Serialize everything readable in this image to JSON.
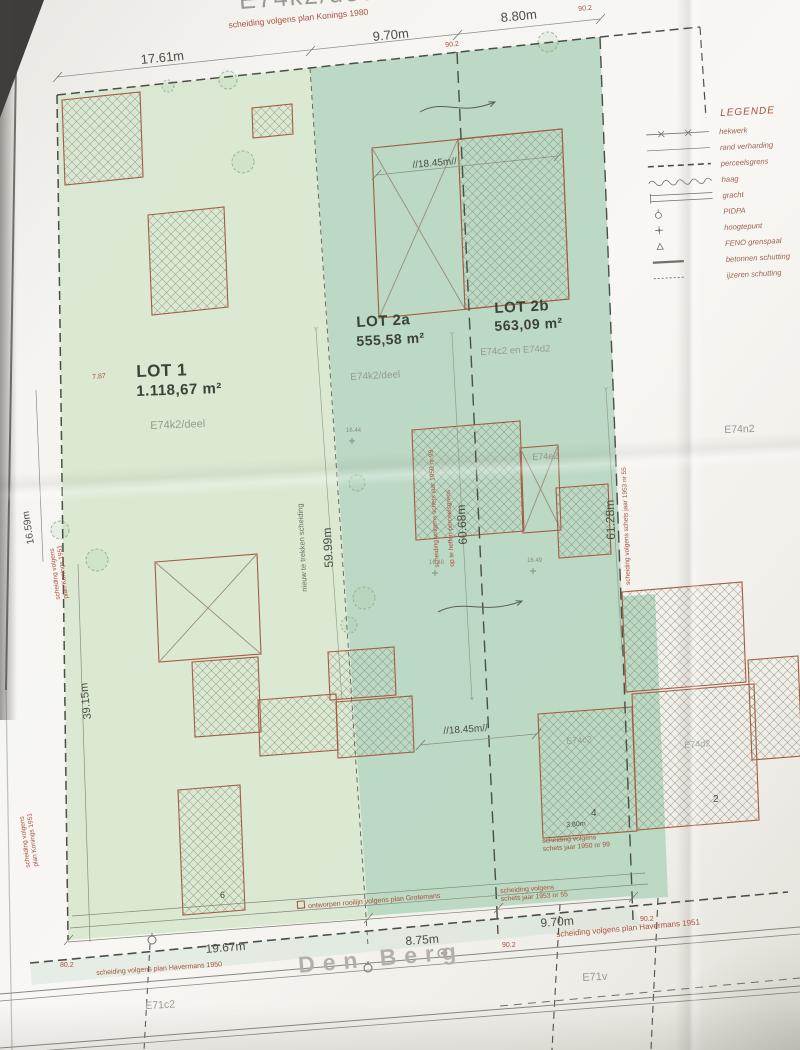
{
  "lots": {
    "lot1": {
      "name": "LOT 1",
      "area": "1.118,67 m²",
      "parcel": "E74k2/deel"
    },
    "lot2a": {
      "name": "LOT 2a",
      "area": "555,58 m²",
      "parcel": "E74k2/deel"
    },
    "lot2b": {
      "name": "LOT 2b",
      "area": "563,09 m²",
      "parcel": "E74c2 en E74d2"
    }
  },
  "measurements": {
    "top_width_left": "17.61m",
    "top_width_mid": "9.70m",
    "top_width_right": "8.80m",
    "depth_lot1": "59.99m",
    "depth_lot2a": "60.68m",
    "depth_lot2b": "61.28m",
    "building_depth_top": "//18.45m//",
    "building_depth_bottom": "//18.45m//",
    "left_upper": "16.59m",
    "left_lower": "39.15m",
    "left_offset": "7.87",
    "bottom_left": "19.67m",
    "bottom_mid": "8.75m",
    "bottom_right": "9.70m",
    "garage_width": "3.80m"
  },
  "angles": {
    "a1": "90.2",
    "a2": "90.2",
    "a3": "90.2",
    "a4": "90.2",
    "a5": "80.2"
  },
  "elevations": {
    "e1": "16.44",
    "e2": "16.48",
    "e3": "16.49"
  },
  "boundary_notes": {
    "konings1980": "scheiding volgens plan Konings 1980",
    "konings1951": "scheiding volgens\nplan Konings 1951",
    "konings1951_b": "scheiding volgens\nplan Konings 1951",
    "schets1950": "scheiding volgens schets jaar 1950 nr 99",
    "op_te_heffen": "op te heffen perceelsgrens",
    "schets1953": "scheiding volgens schets jaar 1953 nr 55",
    "schets1953_bottom": "scheiding volgens\nschets jaar 1953 nr 55",
    "schets1950_garage": "scheiding volgens\nschets jaar 1950 nr 99",
    "havermans1950": "scheiding volgens plan Havermans 1950",
    "havermans1951": "scheiding volgens plan Havermans 1951",
    "rooilijn": "ontworpen rooilijn volgens plan Grotemans",
    "nieuwe_grens": "nieuw te trekken scheiding"
  },
  "parcels": {
    "top": "E74k2/deel",
    "e74e2": "E74e2",
    "e74n2": "E74n2",
    "e74c2": "E74c2",
    "e74d2": "E74d2",
    "e71c2": "E71c2",
    "e71v": "E71v"
  },
  "street": {
    "name": "Den Berg"
  },
  "building_numbers": {
    "b6": "6",
    "b4": "4",
    "b2": "2"
  },
  "legend": {
    "title": "LEGENDE",
    "items": [
      {
        "label": "hekwerk",
        "symbol": "fence-line"
      },
      {
        "label": "rand verharding",
        "symbol": "thin-line"
      },
      {
        "label": "perceelsgrens",
        "symbol": "dashed-line"
      },
      {
        "label": "haag",
        "symbol": "wavy-line"
      },
      {
        "label": "gracht",
        "symbol": "ditch-line"
      },
      {
        "label": "PIDPA",
        "symbol": "pidpa-mark"
      },
      {
        "label": "hoogtepunt",
        "symbol": "elevation-mark"
      },
      {
        "label": "FENO grenspaal",
        "symbol": "boundary-post-mark"
      },
      {
        "label": "betonnen schutting",
        "symbol": "concrete-fence-line"
      },
      {
        "label": "ijzeren schutting",
        "symbol": "iron-fence-line"
      }
    ]
  }
}
